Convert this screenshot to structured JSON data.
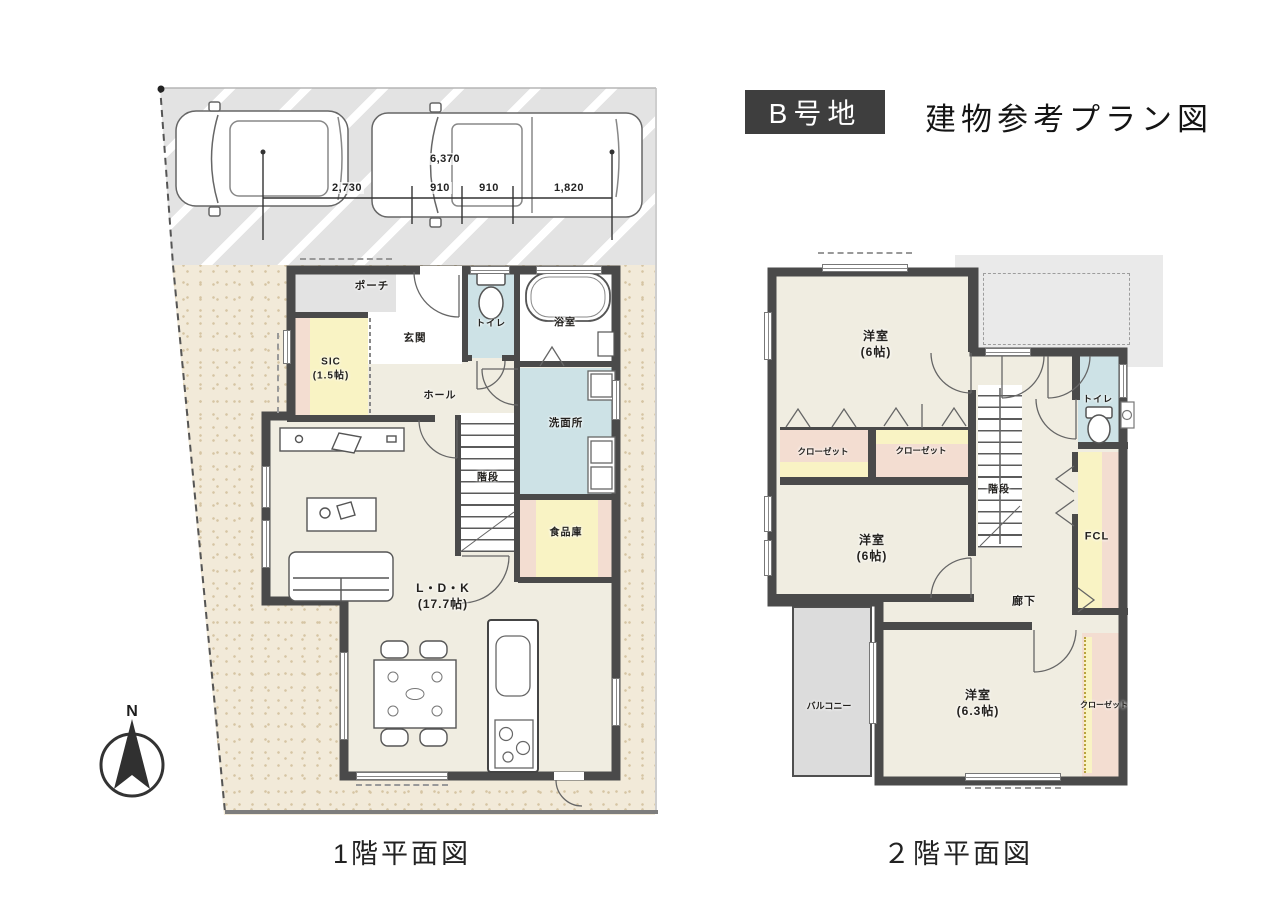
{
  "header": {
    "lot_badge": "B号地",
    "title": "建物参考プラン図"
  },
  "captions": {
    "floor1": "1階平面図",
    "floor2": "２階平面図"
  },
  "compass": {
    "north": "N"
  },
  "site": {
    "dimensions": {
      "total": "6,370",
      "segments": [
        "2,730",
        "910",
        "910",
        "1,820"
      ]
    }
  },
  "floor1": {
    "rooms": {
      "porch": "ポーチ",
      "entrance": "玄関",
      "toilet": "トイレ",
      "bath": "浴室",
      "sic_name": "SIC",
      "sic_size": "(1.5帖)",
      "hall": "ホール",
      "washroom": "洗面所",
      "stairs": "階段",
      "pantry": "食品庫",
      "ldk_name": "L・D・K",
      "ldk_size": "(17.7帖)"
    }
  },
  "floor2": {
    "rooms": {
      "bedroom1_name": "洋室",
      "bedroom1_size": "(6帖)",
      "closet1": "クローゼット",
      "closet2": "クローゼット",
      "toilet": "トイレ",
      "stairs": "階段",
      "bedroom2_name": "洋室",
      "bedroom2_size": "(6帖)",
      "hallway": "廊下",
      "fcl": "FCL",
      "balcony": "バルコニー",
      "bedroom3_name": "洋室",
      "bedroom3_size": "(6.3帖)",
      "closet3": "クローゼット"
    }
  },
  "colors": {
    "wall": "#4a4a4a",
    "floor-cream": "#f0ede1",
    "wet-blue": "#cde2e6",
    "accent-yellow": "#f9f3c4",
    "accent-pink": "#f3ddd1",
    "outdoor-gray": "#e3e3e3",
    "site-beige": "#f2ead9"
  }
}
